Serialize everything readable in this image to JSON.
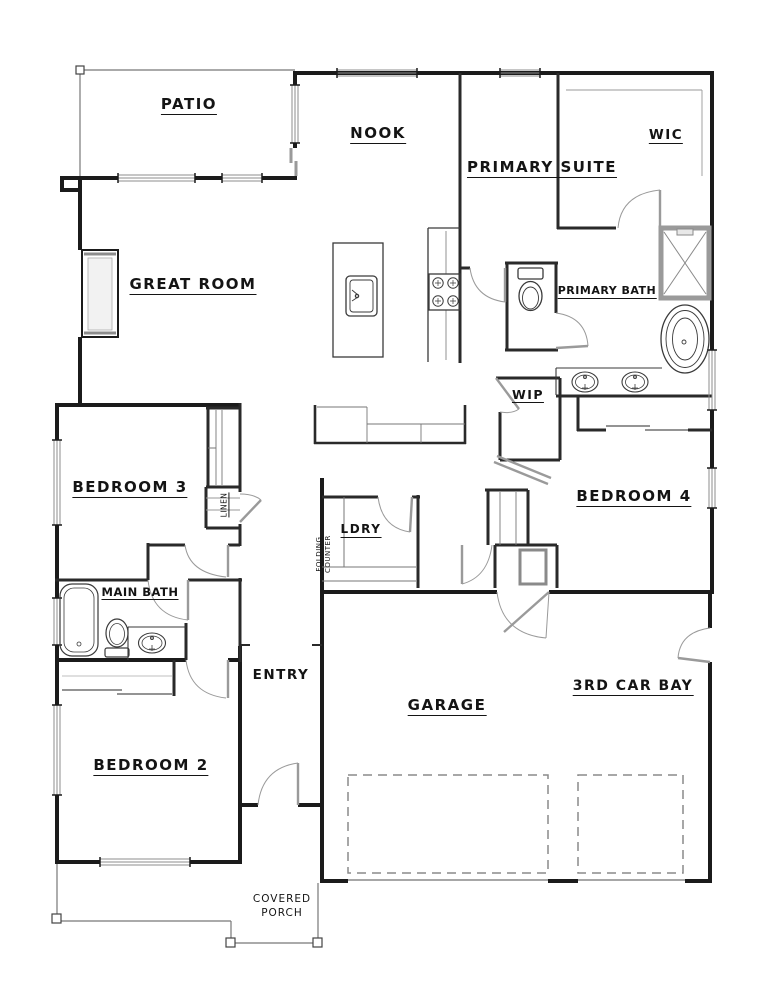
{
  "drawing_type": "residential-floor-plan",
  "colors": {
    "wall": "#1b1b1b",
    "interior_wall": "#2a2a2a",
    "thin_line": "#777777",
    "door_leaf": "#9a9a9a",
    "window_line": "#8c8c8c",
    "garage_door_dashed": "#8a8a8a",
    "background": "#ffffff",
    "label_text": "#141414"
  },
  "rooms": {
    "patio": {
      "label": "PATIO"
    },
    "nook": {
      "label": "NOOK"
    },
    "primary_suite": {
      "label": "PRIMARY SUITE"
    },
    "wic": {
      "label": "WIC"
    },
    "great_room": {
      "label": "GREAT ROOM"
    },
    "primary_bath": {
      "label": "PRIMARY BATH"
    },
    "wip": {
      "label": "WIP"
    },
    "bedroom3": {
      "label": "BEDROOM 3"
    },
    "linen": {
      "label": "LINEN"
    },
    "laundry": {
      "label": "LDRY"
    },
    "folding_counter": {
      "label": "FOLDING COUNTER",
      "line1": "FOLDING",
      "line2": "COUNTER"
    },
    "bedroom4": {
      "label": "BEDROOM 4"
    },
    "main_bath": {
      "label": "MAIN BATH"
    },
    "entry": {
      "label": "ENTRY"
    },
    "bedroom2": {
      "label": "BEDROOM 2"
    },
    "garage": {
      "label": "GARAGE"
    },
    "third_car_bay": {
      "label": "3RD CAR BAY"
    },
    "covered_porch": {
      "label": "COVERED PORCH",
      "line1": "COVERED",
      "line2": "PORCH"
    }
  },
  "fixtures": {
    "kitchen": [
      "island-sink",
      "range-cooktop",
      "buffet-counter"
    ],
    "primary_bath": [
      "toilet",
      "walk-in-shower",
      "freestanding-tub",
      "double-vanity-sinks"
    ],
    "main_bath": [
      "bathtub",
      "toilet",
      "vanity-sink"
    ],
    "utility": [
      "water-heater",
      "folding-counter",
      "linen-shelves",
      "washer-dryer-space"
    ],
    "closets": [
      "wic-shelving",
      "bedroom2-sliding-closet",
      "bedroom3-wardrobe",
      "bedroom4-sliding-closet"
    ]
  }
}
